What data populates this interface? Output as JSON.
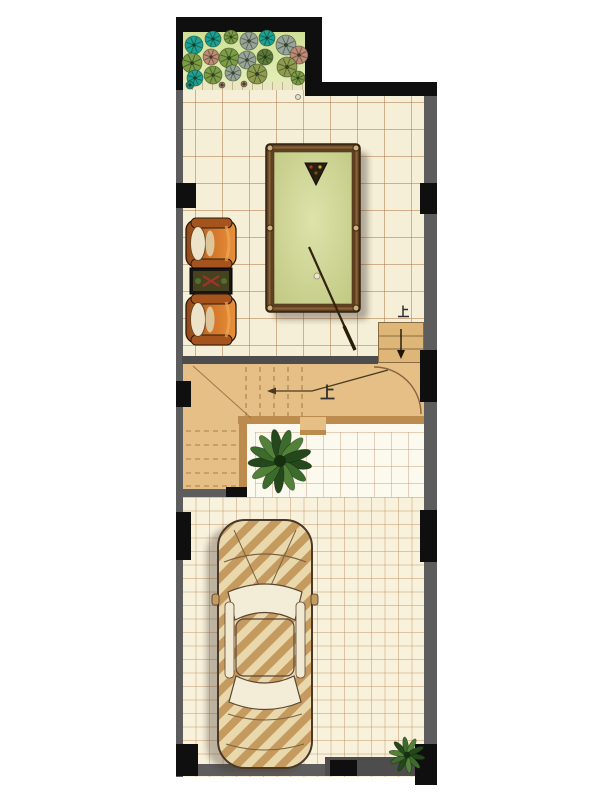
{
  "meta": {
    "type": "architectural floor plan",
    "description": "Ground floor plan: garden bed, tiled game room with billiard table and armchairs, L-shaped staircase, courtyard plant, garage with car"
  },
  "labels": {
    "up_main_stair": "上",
    "up_entry_steps": "上"
  },
  "colors": {
    "wall_black": "#0f0f0f",
    "wall_gray": "#5d5d5d",
    "room_tile_bg": "#f6efd8",
    "room_tile_line": "#c9a170",
    "fine_tile_bg": "#f8f2dd",
    "fine_tile_line": "#d3ab80",
    "stair_fill": "#e5bf85",
    "stair_edge": "#bc8c4e",
    "garden_bg": "#d9e7a4",
    "billiard_frame": "#5e3f21",
    "billiard_felt": "#cbd292",
    "armchair_orange": "#c96f2e",
    "car_stripe": "#c59a5f",
    "plant_leaf": "#3c6b2c"
  },
  "plant_palette": {
    "teal": "#1ba295",
    "green": "#7c9c45",
    "olive": "#8f9c4f",
    "gray": "#98a49a",
    "pink": "#c08a76",
    "dgreen": "#5d7a3a"
  },
  "garden_plants": [
    {
      "cx": 194,
      "cy": 45,
      "r": 9,
      "c": "teal"
    },
    {
      "cx": 213,
      "cy": 39,
      "r": 8,
      "c": "teal"
    },
    {
      "cx": 231,
      "cy": 37,
      "r": 7,
      "c": "green"
    },
    {
      "cx": 249,
      "cy": 41,
      "r": 9,
      "c": "gray"
    },
    {
      "cx": 267,
      "cy": 38,
      "r": 8,
      "c": "teal"
    },
    {
      "cx": 286,
      "cy": 45,
      "r": 10,
      "c": "gray"
    },
    {
      "cx": 299,
      "cy": 55,
      "r": 9,
      "c": "pink"
    },
    {
      "cx": 192,
      "cy": 63,
      "r": 10,
      "c": "green"
    },
    {
      "cx": 211,
      "cy": 57,
      "r": 8,
      "c": "pink"
    },
    {
      "cx": 229,
      "cy": 58,
      "r": 10,
      "c": "green"
    },
    {
      "cx": 247,
      "cy": 60,
      "r": 9,
      "c": "gray"
    },
    {
      "cx": 265,
      "cy": 57,
      "r": 8,
      "c": "dgreen"
    },
    {
      "cx": 287,
      "cy": 67,
      "r": 10,
      "c": "olive"
    },
    {
      "cx": 195,
      "cy": 78,
      "r": 8,
      "c": "teal"
    },
    {
      "cx": 213,
      "cy": 75,
      "r": 9,
      "c": "green"
    },
    {
      "cx": 233,
      "cy": 73,
      "r": 8,
      "c": "gray"
    },
    {
      "cx": 257,
      "cy": 74,
      "r": 10,
      "c": "olive"
    },
    {
      "cx": 298,
      "cy": 78,
      "r": 7,
      "c": "green"
    },
    {
      "cx": 190,
      "cy": 85,
      "r": 4,
      "c": "teal"
    },
    {
      "cx": 222,
      "cy": 85,
      "r": 3,
      "c": "pink"
    },
    {
      "cx": 244,
      "cy": 84,
      "r": 3,
      "c": "pink"
    }
  ],
  "leaf_plants": [
    {
      "cx": 280,
      "cy": 461,
      "r": 30,
      "n": 13
    },
    {
      "cx": 407,
      "cy": 755,
      "r": 17,
      "n": 10
    }
  ]
}
